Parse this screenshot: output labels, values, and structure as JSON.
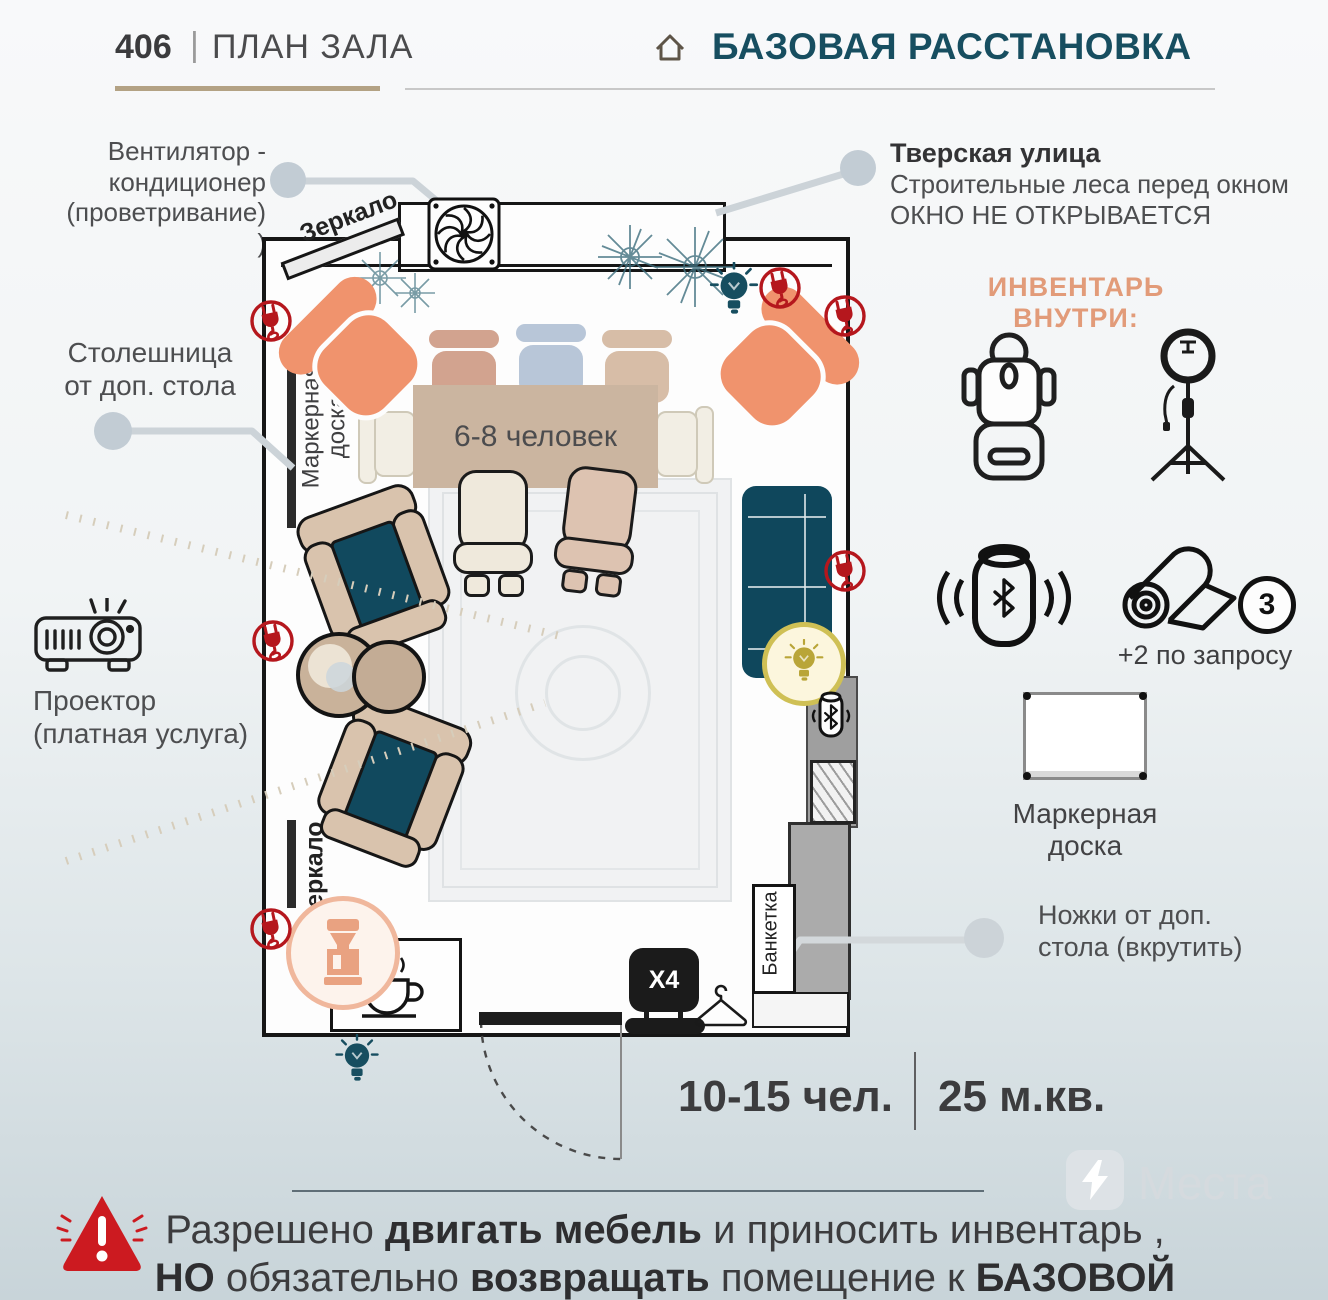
{
  "header": {
    "number": "406",
    "separator": "|",
    "title": "ПЛАН ЗАЛА",
    "subtitle": "БАЗОВАЯ РАССТАНОВКА"
  },
  "callouts": {
    "fan": "Вентилятор -\nкондиционер\n(проветривание) )",
    "tabletop": "Столешница\nот доп. стола",
    "projector": "Проектор\n(платная услуга)",
    "street_title": "Тверская улица",
    "street_line1": "Строительные леса перед окном",
    "street_line2": "ОКНО НЕ ОТКРЫВАЕТСЯ",
    "legs": "Ножки от доп.\nстола (вкрутить)"
  },
  "inventory": {
    "heading": "ИНВЕНТАРЬ ВНУТРИ:",
    "icons": [
      "massage-chair",
      "ring-light",
      "bluetooth-speaker",
      "yoga-mat",
      "marker-board"
    ],
    "mat_count": "3",
    "mat_note": "+2 по запросу",
    "board_label": "Маркерная\nдоска"
  },
  "plan": {
    "mirror_top_label": "Зеркало",
    "mirror_bottom_label": "Зеркало",
    "marker_board_label": "Маркерная\nдоска",
    "table_label": "6-8 человек",
    "bench_label": "Банкетка",
    "chair_stack_label": "X4"
  },
  "stats": {
    "capacity": "10-15 чел.",
    "area": "25 м.кв."
  },
  "watermark": "Места",
  "warning": {
    "l1a": "Разрешено ",
    "l1b": "двигать мебель",
    "l1c": " и приносить инвентарь ,",
    "l2a": "НО",
    "l2b": " обязательно ",
    "l2c": "возвращать",
    "l2d": " помещение к ",
    "l2e": "БАЗОВОЙ РАССТАНОВКЕ"
  },
  "colors": {
    "accent_teal": "#174e60",
    "accent_orange": "#e29b79",
    "furniture_orange": "#f0936d",
    "furniture_teal": "#10485d",
    "plug_red": "#b5171d",
    "alert_red": "#cc1a20",
    "gold": "#b3a284"
  }
}
